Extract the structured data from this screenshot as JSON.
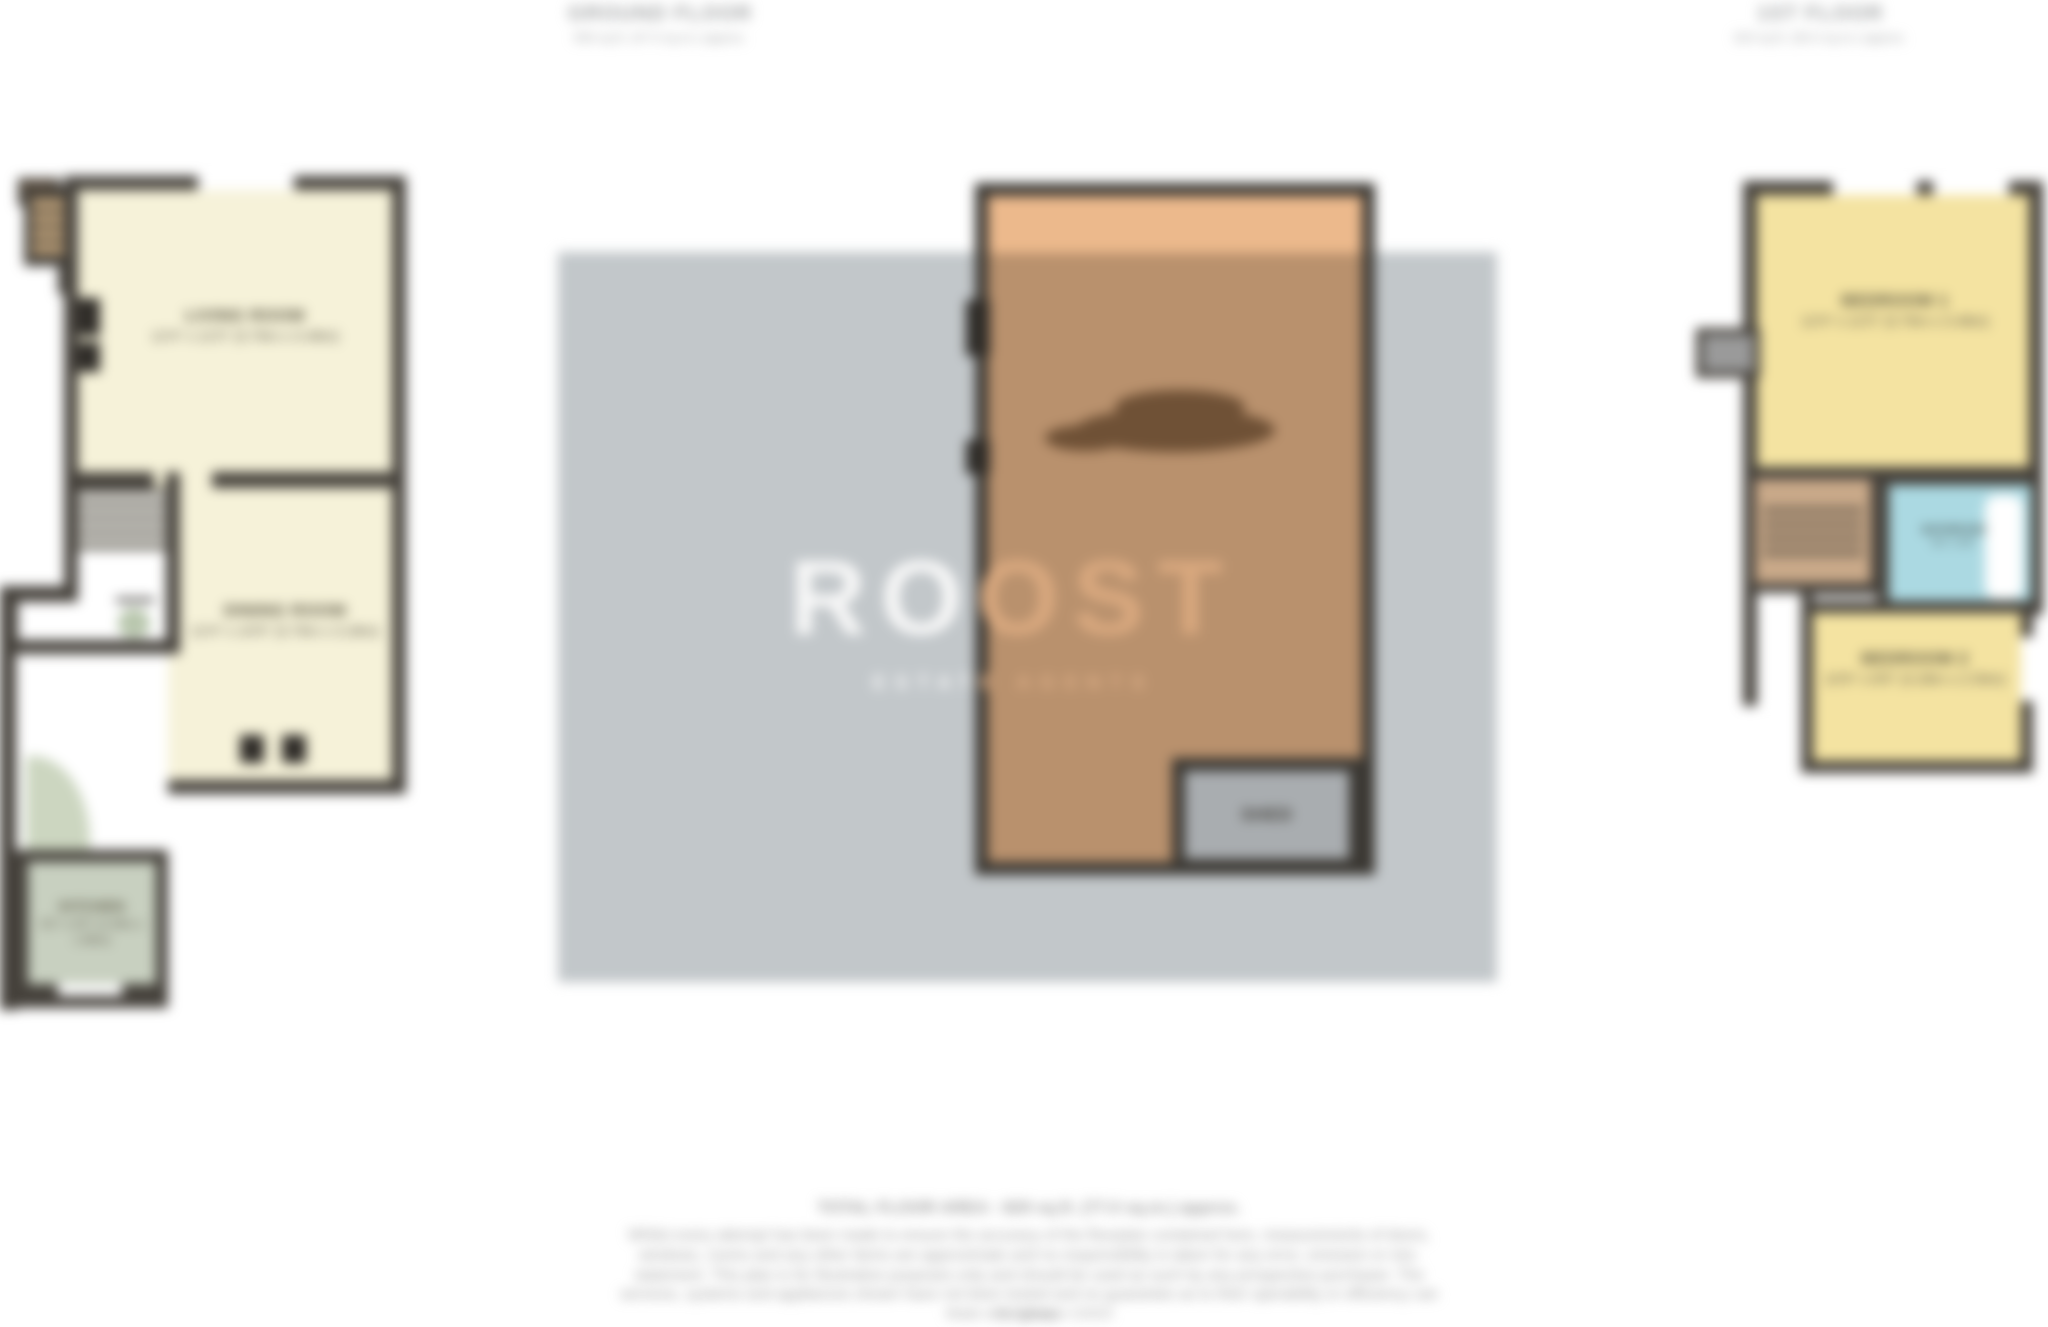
{
  "header": {
    "left_label": {
      "title": "GROUND FLOOR",
      "subtitle": "506 sq.ft. (47.0 sq.m.) approx."
    },
    "right_label": {
      "title": "1ST FLOOR",
      "subtitle": "323 sq.ft. (30.0 sq.m.) approx."
    }
  },
  "watermark": {
    "brand": "ROOST",
    "tagline": "ESTATE AGENTS"
  },
  "ground_floor": {
    "rooms": [
      {
        "name": "LIVING ROOM",
        "dims": "12'4\" x 11'5\" (3.76m x 3.48m)"
      },
      {
        "name": "DINING ROOM",
        "dims": "12'4\" x 10'9\" (3.76m x 3.28m)"
      },
      {
        "name": "KITCHEN",
        "dims": "8'2\" x 6'5\" (2.49m x 1.96m)"
      }
    ]
  },
  "first_floor": {
    "rooms": [
      {
        "name": "BEDROOM 1",
        "dims": "12'4\" x 11'5\" (3.76m x 3.48m)"
      },
      {
        "name": "BATHROOM",
        "dims": "8'2\" x 5'5\""
      },
      {
        "name": "BEDROOM 2",
        "dims": "10'9\" x 8'6\" (3.28m x 2.59m)"
      }
    ]
  },
  "garden": {
    "shed_label": "SHED"
  },
  "footer": {
    "total_area": "TOTAL FLOOR AREA : 829 sq.ft. (77.0 sq.m.) approx.",
    "disclaimer": "Whilst every attempt has been made to ensure the accuracy of the floorplan contained here, measurements of doors, windows, rooms and any other items are approximate and no responsibility is taken for any error, omission or mis-statement. This plan is for illustrative purposes only and should be used as such by any prospective purchaser. The services, systems and appliances shown have not been tested and no guarantee as to their operability or efficiency can be given.",
    "credit": "Made with Metropix ©2023"
  },
  "colors": {
    "wall": "#45413b",
    "cream": "#f6f2d9",
    "yellow": "#f4e3a1",
    "green": "#c8d0c0",
    "blue": "#abd9e2",
    "tan": "#c9a989",
    "garden_light": "#ecb98c",
    "garden_shaded": "#b9916d",
    "watermark_band": "#c2c7ca",
    "shed_fill": "#a9adb0",
    "brand_white": "#f8f8f8",
    "brand_tan": "#d9a87e",
    "text_gray": "#9b9b9b"
  }
}
